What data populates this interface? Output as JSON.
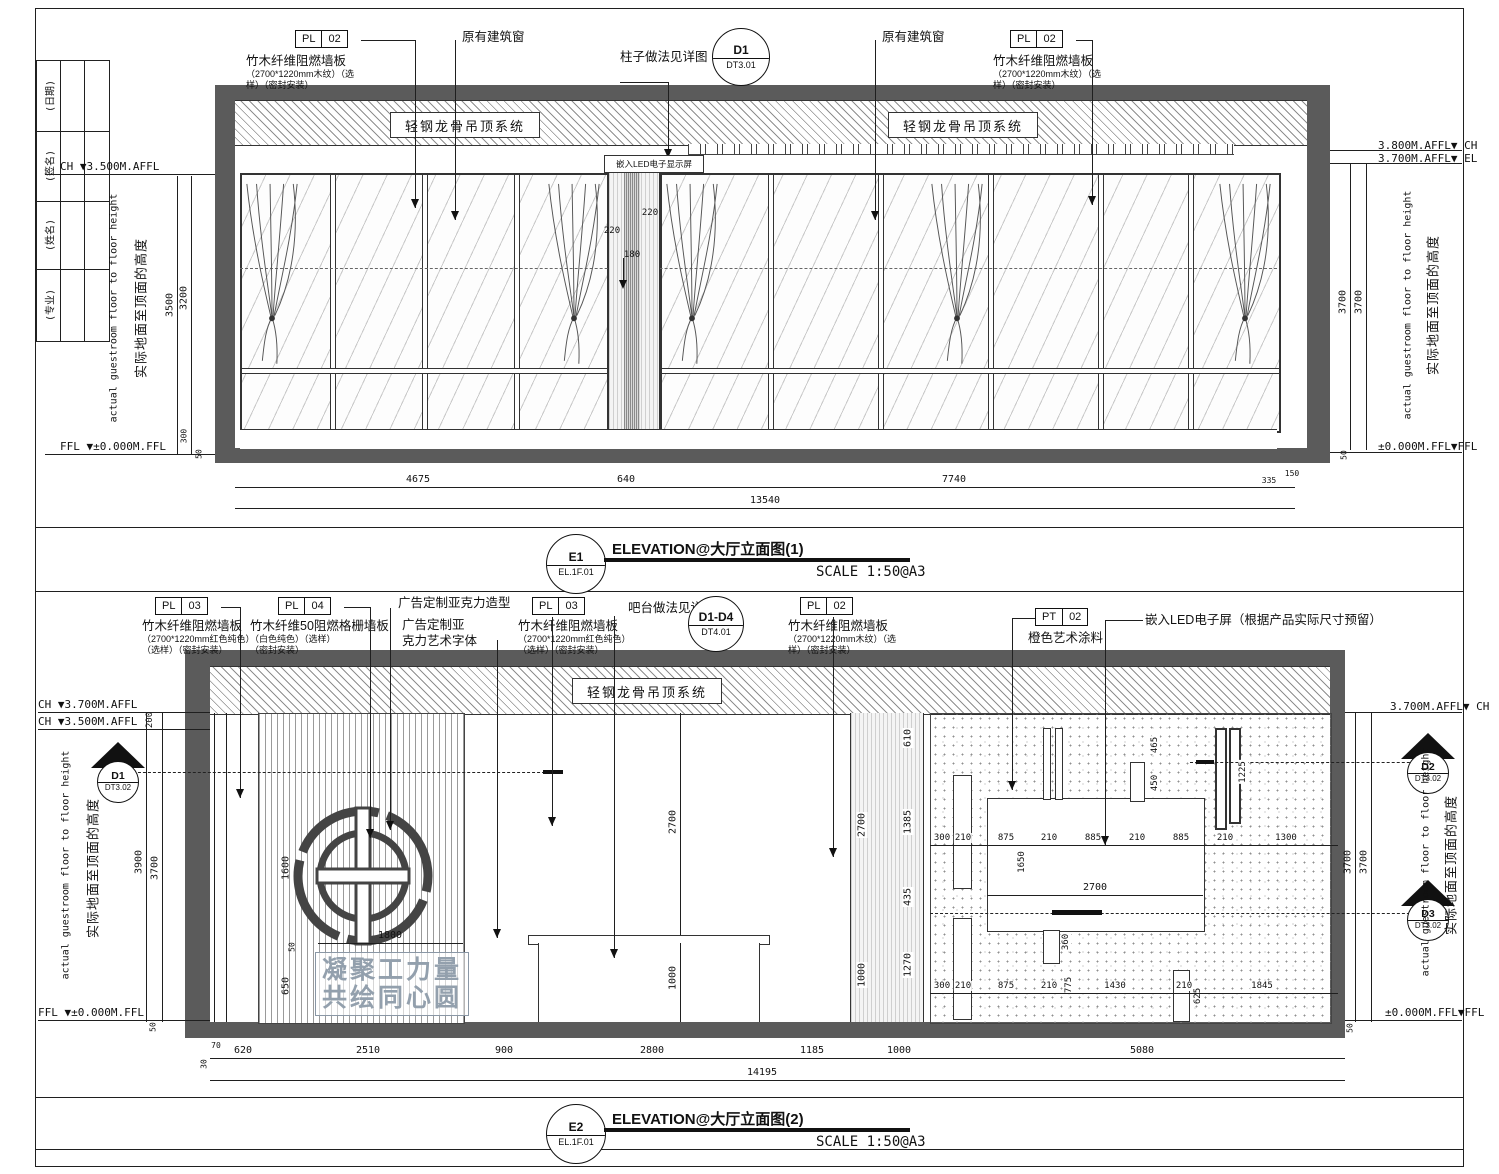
{
  "colors": {
    "wall_gray": "#5b5b5b",
    "line": "#1f1f1f",
    "slogan_gray": "#93a0ad"
  },
  "titleblock": {
    "rows": [
      "(日期)",
      "(签名)",
      "(姓名)",
      "(专业)"
    ]
  },
  "common": {
    "cn_height_note": "实际地面至顶面的高度",
    "en_height_note": "actual guestroom floor to floor height"
  },
  "e1": {
    "ceiling_label": "轻钢龙骨吊顶系统",
    "callouts": {
      "pl02_left": {
        "tag": "PL",
        "num": "02",
        "l1": "竹木纤维阻燃墙板",
        "l2": "（2700*1220mm木纹）（选",
        "l3": "样）（密封安装）"
      },
      "window_left": "原有建筑窗",
      "column_note": "柱子做法见详图",
      "detail": {
        "code": "D1",
        "ref": "DT3.01"
      },
      "window_right": "原有建筑窗",
      "pl02_right": {
        "tag": "PL",
        "num": "02",
        "l1": "竹木纤维阻燃墙板",
        "l2": "（2700*1220mm木纹）（选",
        "l3": "样）（密封安装）"
      },
      "led_box": "嵌入LED电子显示屏"
    },
    "left": {
      "ch": "CH ▼3.500M.AFFL",
      "ffl": "FFL ▼±0.000M.FFL",
      "d3500": "3500",
      "d3200": "3200",
      "d300": "300",
      "d50": "50"
    },
    "right": {
      "lvl_ch": "3.800M.AFFL▼ CH",
      "lvl_el": "3.700M.AFFL▼ EL",
      "lvl_ffl": "±0.000M.FFL▼FFL",
      "d3700a": "3700",
      "d3700b": "3700",
      "d50": "50"
    },
    "inner": {
      "d220a": "220",
      "d220b": "220",
      "d180": "180"
    },
    "bottom": {
      "d4675": "4675",
      "d640": "640",
      "d7740": "7740",
      "d335": "335",
      "d150": "150",
      "total": "13540"
    },
    "title": {
      "code": "E1",
      "ref": "EL.1F.01",
      "label": "ELEVATION@大厅立面图(1)",
      "scale": "SCALE 1:50@A3"
    }
  },
  "e2": {
    "ceiling_label": "轻钢龙骨吊顶系统",
    "callouts": {
      "pl03_left": {
        "tag": "PL",
        "num": "03",
        "l1": "竹木纤维阻燃墙板",
        "l2": "（2700*1220mm红色纯色）",
        "l3": "（选样）（密封安装）"
      },
      "pl04": {
        "tag": "PL",
        "num": "04",
        "l1": "竹木纤维50阻燃格栅墙板",
        "l2": "（白色纯色）（选样）",
        "l3": "（密封安装）"
      },
      "acrylic_shape": "广告定制亚克力造型",
      "acrylic_text_l1": "广告定制亚",
      "acrylic_text_l2": "克力艺术字体",
      "pl03_right": {
        "tag": "PL",
        "num": "03",
        "l1": "竹木纤维阻燃墙板",
        "l2": "（2700*1220mm红色纯色）",
        "l3": "（选样）（密封安装）"
      },
      "bar_note": "吧台做法见详图",
      "detail": {
        "code": "D1-D4",
        "ref": "DT4.01"
      },
      "pl02": {
        "tag": "PL",
        "num": "02",
        "l1": "竹木纤维阻燃墙板",
        "l2": "（2700*1220mm木纹）（选",
        "l3": "样）（密封安装）"
      },
      "pt02": {
        "tag": "PT",
        "num": "02",
        "l1": "橙色艺术涂料"
      },
      "led_note": "嵌入LED电子屏（根据产品实际尺寸预留）"
    },
    "slogan": {
      "l1": "凝聚工力量",
      "l2": "共绘同心圆"
    },
    "left": {
      "ch1": "CH ▼3.700M.AFFL",
      "ch2": "CH ▼3.500M.AFFL",
      "ffl": "FFL ▼±0.000M.FFL",
      "d200": "200",
      "d3900": "3900",
      "d3700": "3700",
      "d50": "50",
      "marker": {
        "code": "D1",
        "ref": "DT3.02"
      }
    },
    "right": {
      "lvl_ch": "3.700M.AFFL▼ CH",
      "lvl_ffl": "±0.000M.FFL▼FFL",
      "d3700a": "3700",
      "d3700b": "3700",
      "d50": "50",
      "marker_d2": {
        "code": "D2",
        "ref": "DT3.02"
      },
      "marker_d3": {
        "code": "D3",
        "ref": "DT3.02"
      }
    },
    "logo_dims": {
      "d1600": "1600",
      "d50": "50",
      "d650": "650",
      "d1800": "1800"
    },
    "mid_dims": {
      "d2700": "2700",
      "d1000": "1000"
    },
    "wood_dims": {
      "d610": "610",
      "d2700": "2700",
      "d1385": "1385",
      "d435": "435",
      "d1270": "1270",
      "d1000": "1000"
    },
    "led_dims": {
      "v465": "465",
      "v450": "450",
      "v1225": "1225",
      "v1650": "1650",
      "w2700": "2700",
      "v360": "360",
      "v775": "775",
      "v625": "625",
      "row_top": [
        "300",
        "210",
        "875",
        "210",
        "885",
        "210",
        "885",
        "210",
        "1300"
      ],
      "row_bottom": [
        "300",
        "210",
        "875",
        "210",
        "1430",
        "210",
        "1845"
      ]
    },
    "bottom": {
      "d30": "30",
      "d70": "70",
      "d620": "620",
      "d2510": "2510",
      "d900": "900",
      "d2800": "2800",
      "d1185": "1185",
      "d1000": "1000",
      "d5080": "5080",
      "total": "14195"
    },
    "title": {
      "code": "E2",
      "ref": "EL.1F.01",
      "label": "ELEVATION@大厅立面图(2)",
      "scale": "SCALE 1:50@A3"
    }
  }
}
